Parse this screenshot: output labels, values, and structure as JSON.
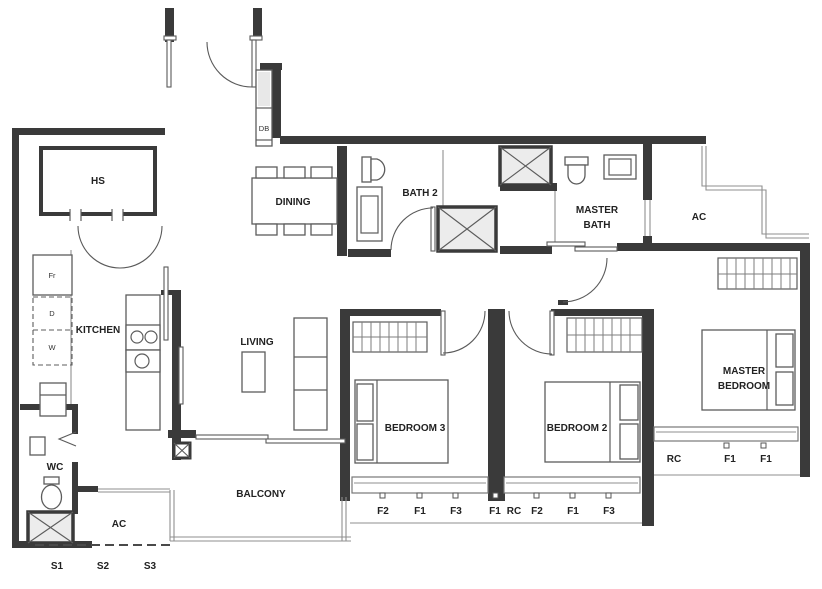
{
  "plan": {
    "rooms": {
      "hs": "HS",
      "dining": "DINING",
      "bath2": "BATH 2",
      "master_bath_1": "MASTER",
      "master_bath_2": "BATH",
      "ac_upper": "AC",
      "kitchen": "KITCHEN",
      "living": "LIVING",
      "wc": "WC",
      "ac_lower": "AC",
      "balcony": "BALCONY",
      "bedroom3": "BEDROOM 3",
      "bedroom2": "BEDROOM 2",
      "master_bedroom_1": "MASTER",
      "master_bedroom_2": "BEDROOM"
    },
    "appliances": {
      "fridge": "Fr",
      "dryer": "D",
      "washer": "W",
      "distribution_board": "DB"
    },
    "facade": {
      "bedroom3_marks": [
        "F2",
        "F1",
        "F3"
      ],
      "hall_marks": [
        "F1",
        "RC",
        "F2",
        "F1",
        "F3"
      ],
      "master_marks": [
        "RC",
        "F1",
        "F1"
      ],
      "shelter_marks": [
        "S1",
        "S2",
        "S3"
      ]
    }
  }
}
